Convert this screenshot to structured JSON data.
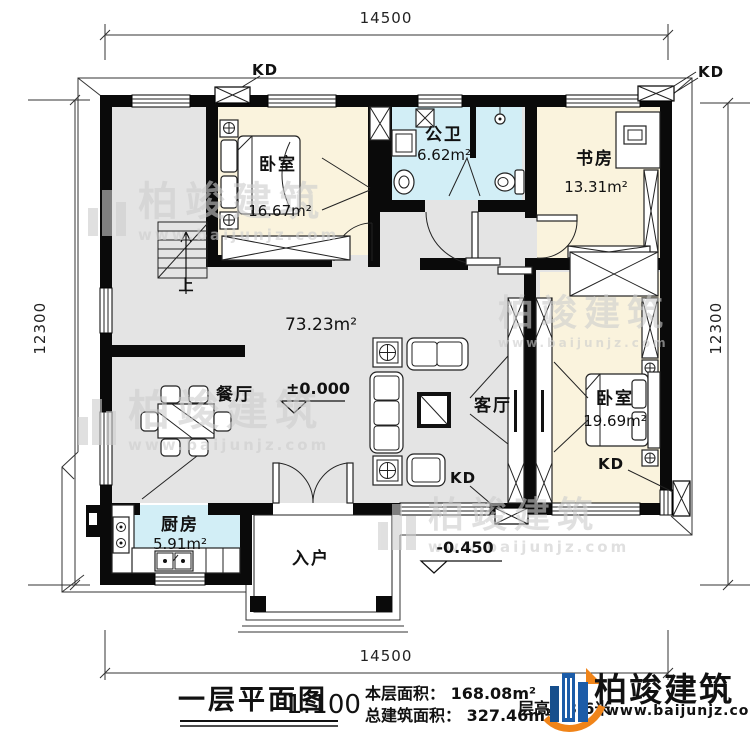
{
  "dimensions": {
    "top": "14500",
    "bottom": "14500",
    "left": "12300",
    "right": "12300"
  },
  "rooms": {
    "bedroom1": {
      "name": "卧室",
      "area": "16.67m²"
    },
    "bathroom": {
      "name": "公卫",
      "area": "6.62m²"
    },
    "study": {
      "name": "书房",
      "area": "13.31m²"
    },
    "bedroom2": {
      "name": "卧室",
      "area": "19.69m²"
    },
    "dining": {
      "name": "餐厅"
    },
    "living": {
      "name": "客厅"
    },
    "kitchen": {
      "name": "厨房",
      "area": "5.91m²"
    },
    "entry": {
      "name": "入户"
    },
    "open_area": "73.23m²"
  },
  "markers": {
    "kd": "KD",
    "stairs_up": "上",
    "elevation_zero": "±0.000",
    "elevation_porch": "-0.450"
  },
  "titleblock": {
    "title": "一层平面图",
    "scale": "1:100",
    "floor_area": "本层面积： 168.08m²",
    "total_area": "总建筑面积： 327.46m²",
    "floor_height": "层高：3.6米"
  },
  "brand": {
    "name": "柏竣建筑",
    "url": "www.baijunjz.com"
  },
  "colors": {
    "wall": "#0a0a0a",
    "floor_gray": "#e4e4e4",
    "room_cream": "#faf3dd",
    "room_blue": "#d2eef6",
    "logo_blue": "#1c5ca8",
    "logo_blue_dark": "#164e8c",
    "logo_orange": "#f08419"
  }
}
